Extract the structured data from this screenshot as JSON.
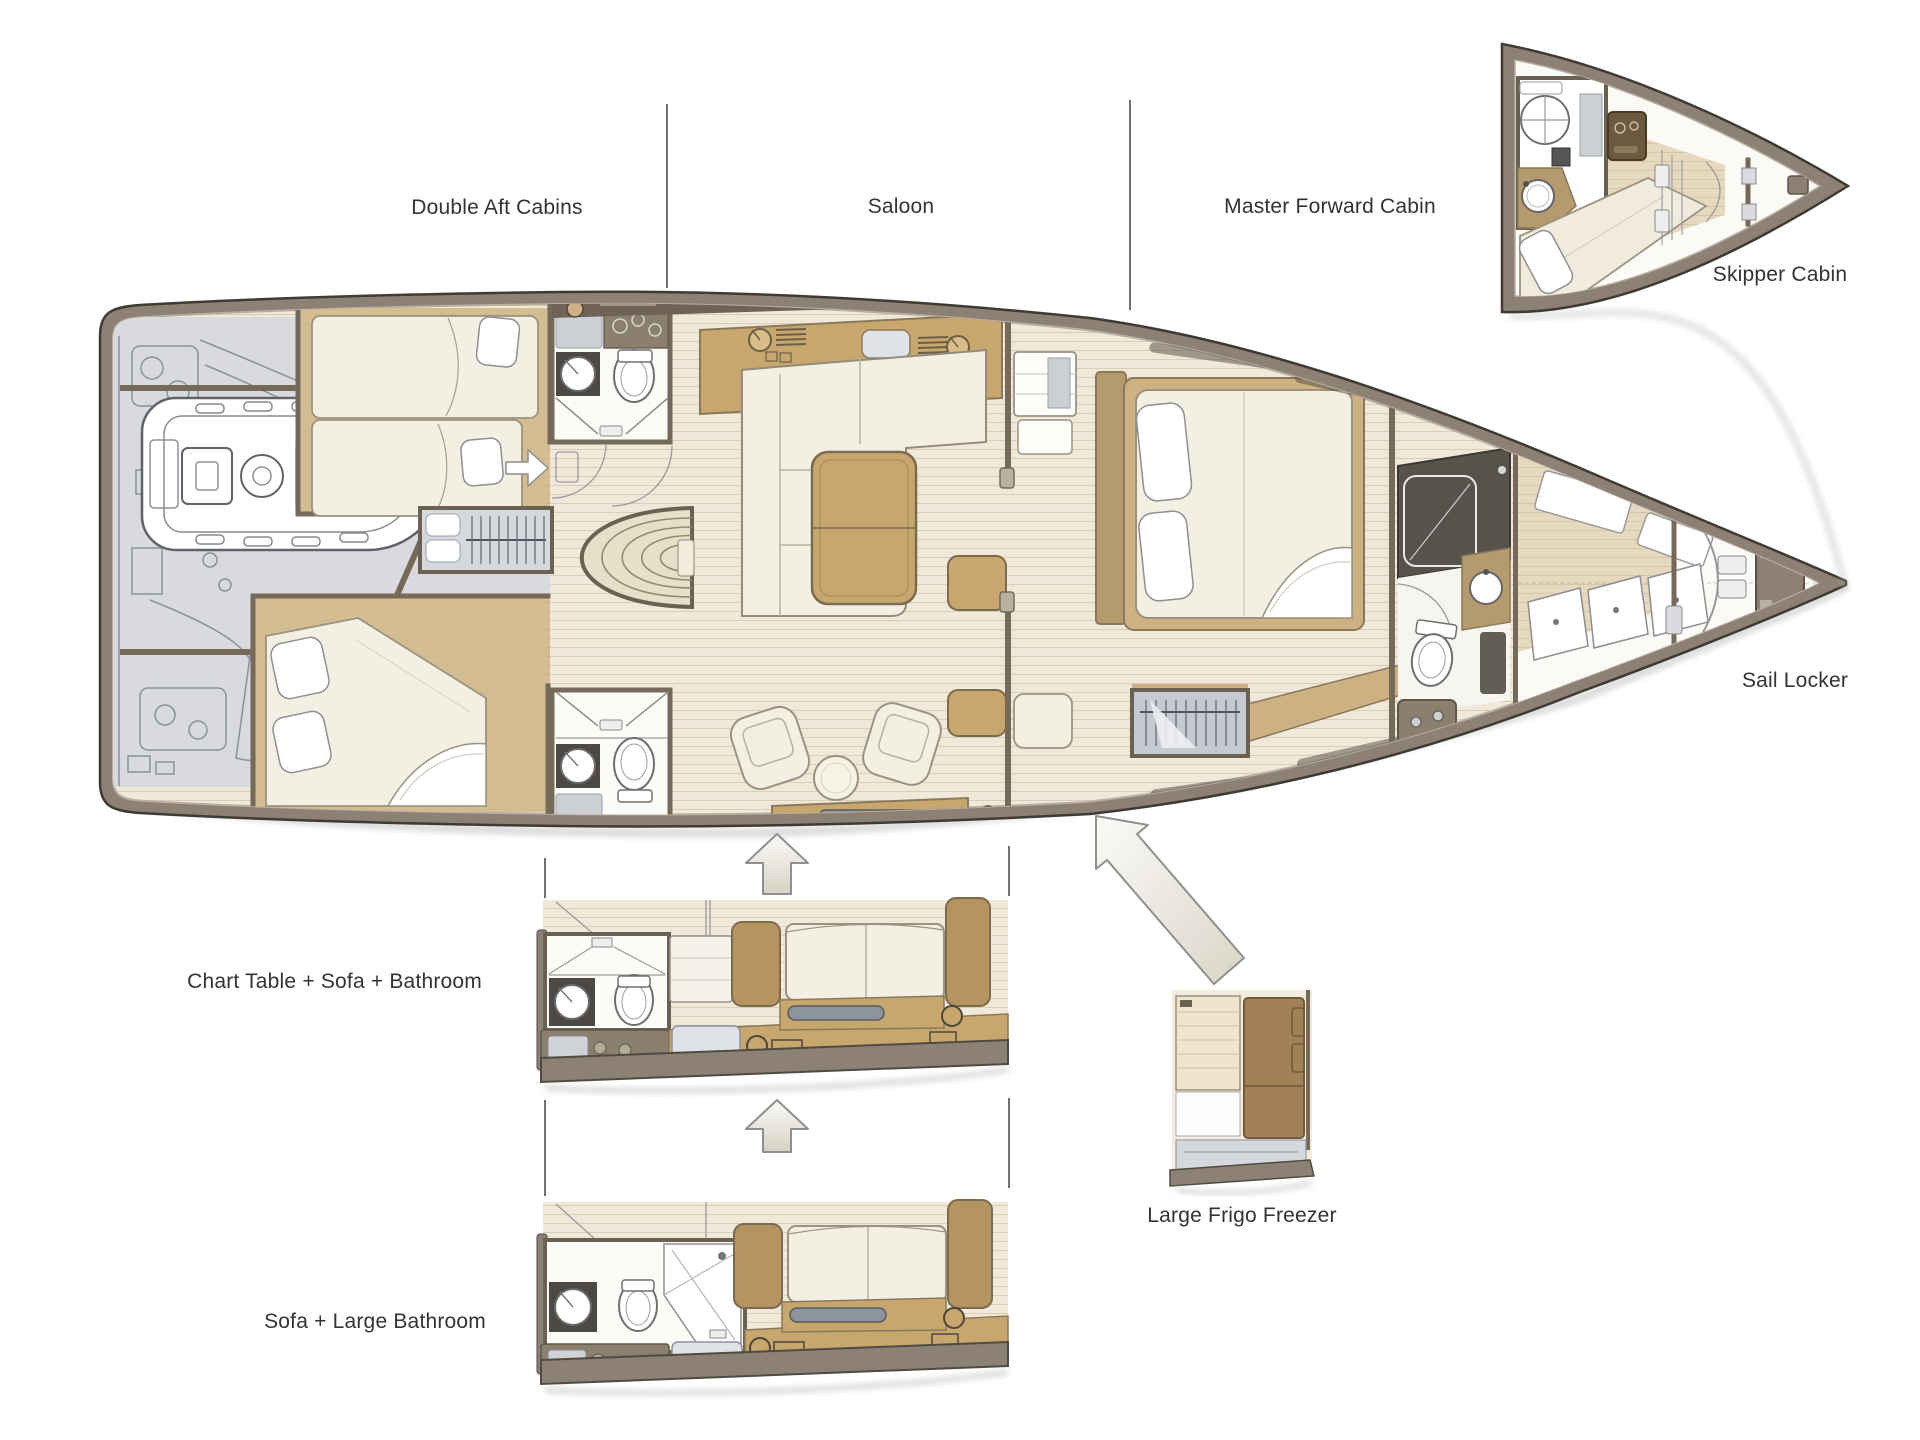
{
  "page": {
    "title": "Yacht interior deck plan with layout options",
    "background": "#ffffff"
  },
  "labels": {
    "double_aft_cabins": "Double Aft Cabins",
    "saloon": "Saloon",
    "master_forward_cabin": "Master Forward Cabin",
    "skipper_cabin": "Skipper Cabin",
    "sail_locker": "Sail Locker",
    "option_chart_table": "Chart Table + Sofa + Bathroom",
    "option_sofa_large_bathroom": "Sofa + Large Bathroom",
    "option_large_frigo_freezer": "Large Frigo Freezer"
  },
  "colors": {
    "hull_rim": "#8c8174",
    "hull_outline": "#3f3a33",
    "floor_cream": "#f0e9da",
    "floor_wood": "#e6d9bf",
    "floor_cabin_tan": "#d5bd92",
    "furniture_tan": "#c8a76e",
    "upholstery_cream": "#f3efe3",
    "technical_gray": "#d8dade",
    "wall_brown": "#75695a",
    "shower_dark": "#56524c",
    "frigo_brown": "#a28157",
    "label_text": "#333333"
  }
}
